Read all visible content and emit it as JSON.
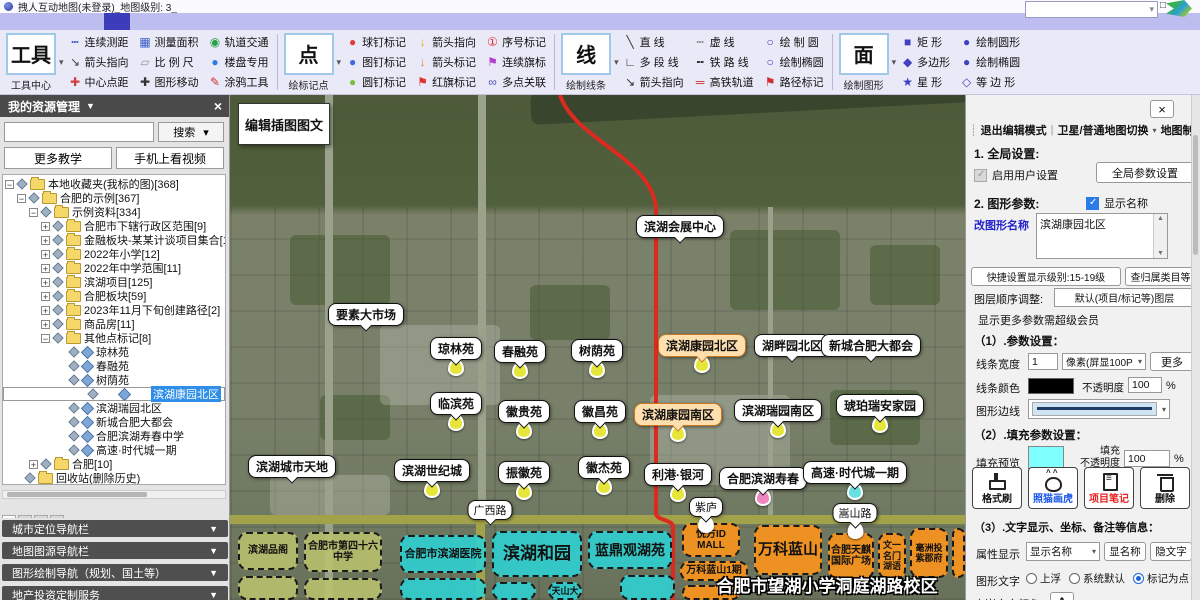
{
  "icons": {
    "down": "▾",
    "tri": "▼",
    "close": "×",
    "min": "—",
    "max": "□",
    "up": "▲",
    "dn": "▼",
    "handle": "┊",
    "pipe": "|"
  },
  "window": {
    "title": "拽人互动地图(未登录)_地图级别: 3_"
  },
  "menu": {
    "items": [
      {
        "label": "文件(F)"
      },
      {
        "label": "系统设置"
      },
      {
        "label": "会员中心"
      },
      {
        "label": "地图选择"
      },
      {
        "label": "绘制图形",
        "cls": "active"
      },
      {
        "label": "房产专用"
      },
      {
        "label": "动画功能"
      },
      {
        "label": "插入图文"
      },
      {
        "label": "资源中心"
      },
      {
        "label": "客服与教学"
      },
      {
        "label": "添加模块+"
      }
    ]
  },
  "toolbar": {
    "groups": [
      {
        "big": "工具",
        "caption": "工具中心",
        "items": [
          {
            "label": "连续测距",
            "g": "┅",
            "c": "#3a5fc8"
          },
          {
            "label": "箭头指向",
            "g": "↘",
            "c": "#444444"
          },
          {
            "label": "中心点距",
            "g": "✚",
            "c": "#d04040"
          },
          {
            "label": "测量面积",
            "g": "▦",
            "c": "#3a5fc8"
          },
          {
            "label": "比 例 尺",
            "g": "▱",
            "c": "#8a97a8"
          },
          {
            "label": "图形移动",
            "g": "✚",
            "c": "#333333"
          },
          {
            "label": "轨道交通",
            "g": "◉",
            "c": "#2aa04a"
          },
          {
            "label": "楼盘专用",
            "g": "●",
            "c": "#2a7de0"
          },
          {
            "label": "涂鸦工具",
            "g": "✎",
            "c": "#d03030"
          }
        ]
      },
      {
        "big": "点",
        "caption": "绘标记点",
        "items": [
          {
            "label": "球钉标记",
            "g": "●",
            "c": "#e03a3a"
          },
          {
            "label": "图钉标记",
            "g": "●",
            "c": "#3a6ae0"
          },
          {
            "label": "圆钉标记",
            "g": "●",
            "c": "#7ac040"
          },
          {
            "label": "箭头指向",
            "g": "↓",
            "c": "#f0b000"
          },
          {
            "label": "箭头标记",
            "g": "↓",
            "c": "#f08020"
          },
          {
            "label": "红旗标记",
            "g": "⚑",
            "c": "#e03030"
          },
          {
            "label": "序号标记",
            "g": "①",
            "c": "#e03030"
          },
          {
            "label": "连续旗标",
            "g": "⚑",
            "c": "#b040d0"
          },
          {
            "label": "多点关联",
            "g": "∞",
            "c": "#5050c0"
          }
        ]
      },
      {
        "big": "线",
        "caption": "绘制线条",
        "items": [
          {
            "label": "直 线",
            "g": "╲",
            "c": "#333333"
          },
          {
            "label": "多 段 线",
            "g": "∟",
            "c": "#333333"
          },
          {
            "label": "箭头指向",
            "g": "↘",
            "c": "#333333"
          },
          {
            "label": "虚 线",
            "g": "┄",
            "c": "#333333"
          },
          {
            "label": "铁 路 线",
            "g": "╍",
            "c": "#333333"
          },
          {
            "label": "高铁轨道",
            "g": "═",
            "c": "#d03030"
          },
          {
            "label": "绘 制 圆",
            "g": "○",
            "c": "#4040c0"
          },
          {
            "label": "绘制椭圆",
            "g": "○",
            "c": "#4040c0"
          },
          {
            "label": "路径标记",
            "g": "⚑",
            "c": "#d03030"
          }
        ]
      },
      {
        "big": "面",
        "caption": "绘制图形",
        "items": [
          {
            "label": "矩  形",
            "g": "■",
            "c": "#4040c0"
          },
          {
            "label": "多边形",
            "g": "◆",
            "c": "#4040c0"
          },
          {
            "label": "星  形",
            "g": "★",
            "c": "#4040c0"
          },
          {
            "label": "绘制圆形",
            "g": "●",
            "c": "#4040c0"
          },
          {
            "label": "绘制椭圆",
            "g": "●",
            "c": "#4040c0"
          },
          {
            "label": "等 边 形",
            "g": "◇",
            "c": "#4040c0"
          }
        ]
      }
    ]
  },
  "sidebar": {
    "header": "我的资源管理",
    "search_button": "搜索",
    "more_teach": "更多教学",
    "phone_video": "手机上看视频",
    "tree": [
      {
        "pad": 2,
        "toggle": "−",
        "label": "本地收藏夹(我标的图)[368]"
      },
      {
        "pad": 14,
        "toggle": "−",
        "label": "合肥的示例[367]"
      },
      {
        "pad": 26,
        "toggle": "−",
        "label": "示例资料[334]"
      },
      {
        "pad": 38,
        "toggle": "+",
        "label": "合肥市下辖行政区范围[9]"
      },
      {
        "pad": 38,
        "toggle": "+",
        "label": "金融板块-某某计谈项目集合[10]"
      },
      {
        "pad": 38,
        "toggle": "+",
        "label": "2022年小学[12]"
      },
      {
        "pad": 38,
        "toggle": "+",
        "label": "2022年中学范围[11]"
      },
      {
        "pad": 38,
        "toggle": "+",
        "label": "滨湖项目[125]"
      },
      {
        "pad": 38,
        "toggle": "+",
        "label": "合肥板块[59]"
      },
      {
        "pad": 38,
        "toggle": "+",
        "label": "2023年11月下旬创建路径[2]"
      },
      {
        "pad": 38,
        "toggle": "+",
        "label": "商品房[11]"
      },
      {
        "pad": 38,
        "toggle": "−",
        "label": "其他点标记[8]"
      },
      {
        "pad": 54,
        "toggle": "",
        "label": "琼林苑",
        "cls": "leaf"
      },
      {
        "pad": 54,
        "toggle": "",
        "label": "春融苑",
        "cls": "leaf"
      },
      {
        "pad": 54,
        "toggle": "",
        "label": "树荫苑",
        "cls": "leaf"
      },
      {
        "pad": 54,
        "toggle": "",
        "label": "滨湖康园北区",
        "cls": "leaf sel"
      },
      {
        "pad": 54,
        "toggle": "",
        "label": "滨湖瑞园北区",
        "cls": "leaf"
      },
      {
        "pad": 54,
        "toggle": "",
        "label": "新城合肥大都会",
        "cls": "leaf"
      },
      {
        "pad": 54,
        "toggle": "",
        "label": "合肥滨湖寿春中学",
        "cls": "leaf"
      },
      {
        "pad": 54,
        "toggle": "",
        "label": "高速·时代城一期",
        "cls": "leaf"
      },
      {
        "pad": 26,
        "toggle": "+",
        "label": "合肥[10]"
      },
      {
        "pad": 10,
        "toggle": "",
        "label": "回收站(删除历史)"
      }
    ],
    "tabs": [
      {
        "label": "收藏夹",
        "cls": "on"
      },
      {
        "label": "个性化图文"
      },
      {
        "label": "资源管理"
      },
      {
        "label": "搜索"
      }
    ],
    "accordions": [
      {
        "label": "城市定位导航栏",
        "y": 425
      },
      {
        "label": "地图图源导航栏",
        "y": 447
      },
      {
        "label": "图形绘制导航（规划、国土等）",
        "y": 469
      },
      {
        "label": "地产投资定制服务",
        "y": 491
      }
    ]
  },
  "map": {
    "edit_box": "编辑插图图文",
    "caption": "合肥市望湖小学洞庭湖路校区",
    "labels": [
      {
        "text": "滨湖会展中心",
        "x": 450,
        "y": 120
      },
      {
        "text": "要素大市场",
        "x": 136,
        "y": 208
      },
      {
        "text": "琼林苑",
        "x": 226,
        "y": 242,
        "mk": "#e6e63a"
      },
      {
        "text": "春融苑",
        "x": 290,
        "y": 245,
        "mk": "#e6e63a"
      },
      {
        "text": "树荫苑",
        "x": 367,
        "y": 244,
        "mk": "#e6e63a"
      },
      {
        "text": "滨湖康园北区",
        "x": 472,
        "y": 239,
        "cls": "hl",
        "mk": "#e6e63a"
      },
      {
        "text": "湖畔园北区",
        "x": 562,
        "y": 239
      },
      {
        "text": "新城合肥大都会",
        "x": 641,
        "y": 239
      },
      {
        "text": "临滨苑",
        "x": 226,
        "y": 297,
        "mk": "#e6e63a"
      },
      {
        "text": "徽贵苑",
        "x": 294,
        "y": 305,
        "mk": "#e6e63a"
      },
      {
        "text": "徽昌苑",
        "x": 370,
        "y": 305,
        "mk": "#e6e63a"
      },
      {
        "text": "滨湖康园南区",
        "x": 448,
        "y": 308,
        "cls": "hl",
        "mk": "#e6e63a"
      },
      {
        "text": "滨湖瑞园南区",
        "x": 548,
        "y": 304,
        "mk": "#e6e63a"
      },
      {
        "text": "琥珀瑞安家园",
        "x": 650,
        "y": 299,
        "mk": "#e6e63a"
      },
      {
        "text": "滨湖城市天地",
        "x": 62,
        "y": 360
      },
      {
        "text": "滨湖世纪城",
        "x": 202,
        "y": 364,
        "mk": "#e6e63a"
      },
      {
        "text": "振徽苑",
        "x": 294,
        "y": 366,
        "mk": "#e6e63a"
      },
      {
        "text": "徽杰苑",
        "x": 374,
        "y": 361,
        "mk": "#e6e63a"
      },
      {
        "text": "利港·银河",
        "x": 448,
        "y": 368,
        "mk": "#e6e63a"
      },
      {
        "text": "合肥滨湖寿春",
        "x": 533,
        "y": 372,
        "mk": "#ee86c0"
      },
      {
        "text": "高速·时代城一期",
        "x": 625,
        "y": 366,
        "mk": "#66e0e0"
      },
      {
        "text": "广西路",
        "x": 260,
        "y": 405,
        "cls": "sm"
      },
      {
        "text": "紫庐",
        "x": 476,
        "y": 402,
        "cls": "sm",
        "mk": "#ffffff"
      },
      {
        "text": "嵩山路",
        "x": 625,
        "y": 408,
        "cls": "sm",
        "mk": "#ffffff"
      }
    ],
    "zones": [
      {
        "text": "滨湖品阁",
        "x": 8,
        "y": 437,
        "w": 60,
        "h": 38,
        "cls": "z-olive",
        "fs": 10
      },
      {
        "text": "合肥市第四十六中学",
        "x": 74,
        "y": 437,
        "w": 78,
        "h": 40,
        "cls": "z-olive",
        "fs": 10
      },
      {
        "text": "",
        "x": 8,
        "y": 481,
        "w": 60,
        "h": 24,
        "cls": "z-olive"
      },
      {
        "text": "",
        "x": 74,
        "y": 483,
        "w": 78,
        "h": 22,
        "cls": "z-olive"
      },
      {
        "text": "合肥市滨湖医院",
        "x": 170,
        "y": 440,
        "w": 86,
        "h": 38,
        "cls": "z-cyan",
        "fs": 11
      },
      {
        "text": "滨湖和园",
        "x": 262,
        "y": 436,
        "w": 90,
        "h": 46,
        "cls": "z-cyan",
        "fs": 17
      },
      {
        "text": "蓝鼎观湖苑",
        "x": 358,
        "y": 436,
        "w": 84,
        "h": 38,
        "cls": "z-cyan",
        "fs": 14
      },
      {
        "text": "天山大",
        "x": 318,
        "y": 487,
        "w": 34,
        "h": 18,
        "cls": "z-cyan",
        "fs": 9
      },
      {
        "text": "",
        "x": 170,
        "y": 483,
        "w": 86,
        "h": 22,
        "cls": "z-cyan"
      },
      {
        "text": "",
        "x": 262,
        "y": 487,
        "w": 44,
        "h": 18,
        "cls": "z-cyan"
      },
      {
        "text": "",
        "x": 390,
        "y": 480,
        "w": 55,
        "h": 25,
        "cls": "z-cyan"
      },
      {
        "text": "悦方ID MALL",
        "x": 452,
        "y": 428,
        "w": 58,
        "h": 34,
        "cls": "z-orange",
        "fs": 10
      },
      {
        "text": "万科蓝山1期",
        "x": 450,
        "y": 466,
        "w": 68,
        "h": 20,
        "cls": "z-orange",
        "fs": 10
      },
      {
        "text": "万科蓝山",
        "x": 524,
        "y": 430,
        "w": 68,
        "h": 50,
        "cls": "z-orange",
        "fs": 15
      },
      {
        "text": "合肥天麒国际广场",
        "x": 598,
        "y": 438,
        "w": 46,
        "h": 46,
        "cls": "z-orange",
        "fs": 10
      },
      {
        "text": "文一名门湖语",
        "x": 648,
        "y": 438,
        "w": 28,
        "h": 46,
        "cls": "z-orange",
        "fs": 9
      },
      {
        "text": "毫洲投紫郡府",
        "x": 680,
        "y": 433,
        "w": 38,
        "h": 50,
        "cls": "z-orange",
        "fs": 9
      },
      {
        "text": "",
        "x": 452,
        "y": 490,
        "w": 58,
        "h": 15,
        "cls": "z-orange"
      },
      {
        "text": "",
        "x": 722,
        "y": 433,
        "w": 13,
        "h": 50,
        "cls": "z-orange"
      }
    ]
  },
  "rightpanel": {
    "exit_edit": "退出编辑模式",
    "map_switch": "卫星/普通地图切换",
    "map_draw": "地图制图",
    "sec1": "1. 全局设置:",
    "enable_user": "启用用户设置",
    "global_btn": "全局参数设置",
    "sec2": "2. 图形参数:",
    "show_name": "显示名称",
    "rename_label": "改图形名称",
    "rename_value": "滨湖康园北区",
    "quick_btn": "快捷设置显示级别:15-19级",
    "category_btn": "查归属类目等",
    "layer_label": "图层顺序调整:",
    "layer_value": "默认(项目/标记等)图层",
    "vip_note": "显示更多参数需超级会员",
    "p1": "（1）.参数设置：",
    "line_width_label": "线条宽度",
    "line_width_value": "1",
    "line_width_unit": "像素(屏显100P",
    "more_btn": "更多",
    "line_color_label": "线条颜色",
    "opacity_label": "不透明度",
    "opacity_value": "100",
    "percent": "%",
    "edge_label": "图形边线",
    "p2": "（2）.填充参数设置：",
    "fill_preview_label": "填充预览",
    "fill_op1": "填充",
    "fill_op2": "不透明度",
    "fill_opacity_value": "100",
    "fill_color": "#80ffff",
    "line_color": "#000000",
    "tools": [
      {
        "label": "格式刷",
        "cls": "t-brush"
      },
      {
        "label": "照猫画虎",
        "cls": "t-cat blue"
      },
      {
        "label": "项目笔记",
        "cls": "t-note red"
      },
      {
        "label": "删除",
        "cls": "t-trash"
      }
    ],
    "p3": "（3）.文字显示、坐标、备注等信息：",
    "attr_label": "属性显示",
    "attr_value": "显示名称",
    "show_btn": "显名称",
    "hide_btn": "隐文字",
    "text_mode_label": "图形文字",
    "radios": [
      {
        "label": "上浮"
      },
      {
        "label": "系统默认"
      },
      {
        "label": "标记为点",
        "cls": "on"
      }
    ],
    "embed_label": "内嵌文字颜色",
    "embed_btn": "A"
  }
}
